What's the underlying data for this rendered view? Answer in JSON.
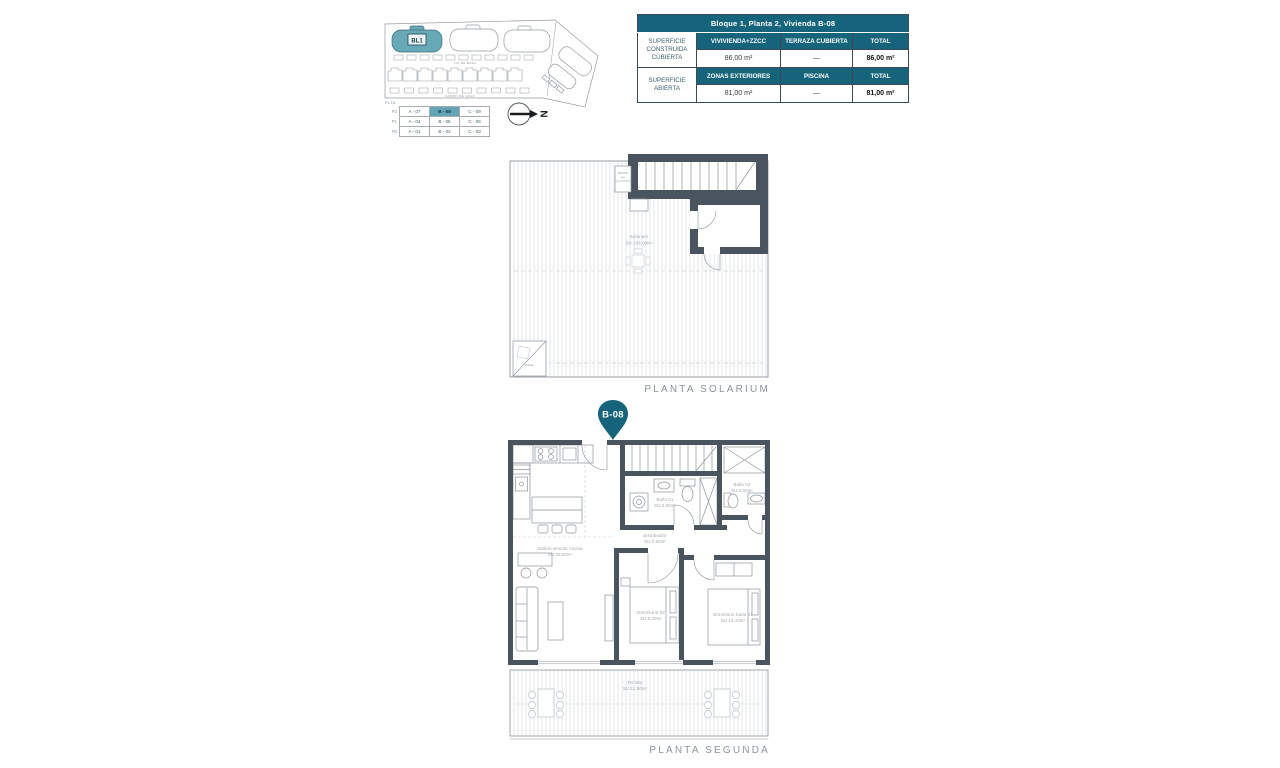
{
  "site_plan": {
    "block_label": "BL1",
    "street_top": "VIA DE BAZA",
    "street_bottom": "CAMPO DE GOLF",
    "north_label": "N",
    "legend": {
      "header": "PLTA.",
      "rows": [
        {
          "level": "P2",
          "cells": [
            "A - 07",
            "B - 08",
            "C - 09"
          ]
        },
        {
          "level": "P1",
          "cells": [
            "A - 04",
            "B - 05",
            "C - 06"
          ]
        },
        {
          "level": "P0",
          "cells": [
            "A - 01",
            "B - 02",
            "C - 03"
          ]
        }
      ],
      "highlight": {
        "row": 0,
        "col": 1,
        "value": "B - 08"
      }
    }
  },
  "summary_table": {
    "title": "Bloque 1, Planta 2, Vivienda B-08",
    "sections": [
      {
        "row_label": "SUPERFICIE CONSTRUIDA CUBIERTA",
        "columns": [
          "VIVIVIENDA+ZZCC",
          "TERRAZA CUBIERTA",
          "TOTAL"
        ],
        "values": [
          "86,00 m²",
          "—",
          "86,00 m²"
        ]
      },
      {
        "row_label": "SUPERFICIE ABIERTA",
        "columns": [
          "ZONAS EXTERIORES",
          "PISCINA",
          "TOTAL"
        ],
        "values": [
          "81,00 m²",
          "—",
          "81,00 m²"
        ]
      }
    ]
  },
  "solarium_plan": {
    "caption": "PLANTA SOLARIUM",
    "room_name": "Solarium",
    "room_area": "SU:103,00m²",
    "shaft_line1": "BAJTE",
    "shaft_line2": "PV",
    "shower_label": "Ducha"
  },
  "pin": {
    "label": "B-08"
  },
  "second_plan": {
    "caption": "PLANTA SEGUNDA",
    "rooms": {
      "salon": {
        "name": "Salón/comedor cocina",
        "area": "SU:30,00m²"
      },
      "distribuidor": {
        "name": "Distribuidor",
        "area": "SU:2,80m²"
      },
      "bano1": {
        "name": "Baño 01",
        "area": "SU:3,80m²"
      },
      "bano2": {
        "name": "Baño 02",
        "area": "SU:3,50m²"
      },
      "dorm2": {
        "name": "Dormitorio 02",
        "area": "SU:9,20m²"
      },
      "suite1": {
        "name": "Dormitorio Suite 01",
        "area": "SU:13,10m²"
      },
      "terraza": {
        "name": "Terraza",
        "area": "SU:21,00m²"
      }
    }
  },
  "colors": {
    "teal": "#15647b",
    "teal_light": "#68a9b8",
    "highlight_cell": "#63a5b5",
    "wall": "#4a545f",
    "plan_line": "#8d959c",
    "label_gray": "#9aa2a8"
  }
}
